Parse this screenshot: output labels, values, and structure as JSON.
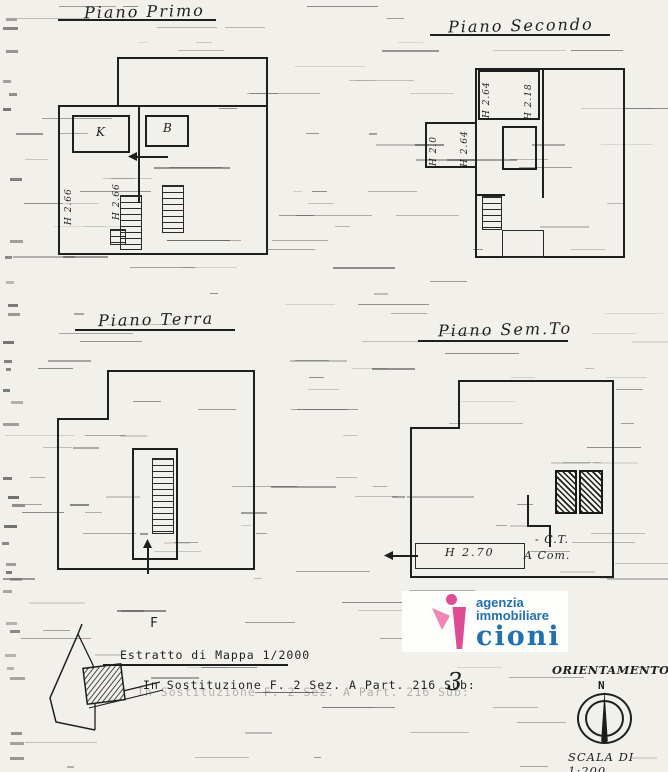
{
  "page": {
    "bg": "#f2f0ea",
    "ink": "#1f1f1f"
  },
  "plans": {
    "primo": {
      "title": "Piano Primo",
      "room_k": "K",
      "room_b": "B",
      "heights": [
        "H 2.66",
        "H 2.66"
      ]
    },
    "secondo": {
      "title": "Piano Secondo",
      "heights": [
        "H 2.64",
        "H 2.18",
        "H 2.0",
        "H 2.64"
      ]
    },
    "terra": {
      "title": "Piano Terra"
    },
    "sem": {
      "title": "Piano Sem.To",
      "height_label": "H 2.70",
      "ct_label": "- C.T.",
      "acom_label": "A Com."
    }
  },
  "footer": {
    "f_label": "F",
    "estratto": "Estratto di Mappa 1/2000",
    "sostituzione": "In Sostituzione  F. 2  Sez. A  Part. 216  Sub:",
    "sub_value": "3"
  },
  "logo": {
    "line1": "agenzia",
    "line2": "immobiliare",
    "line3": "cioni",
    "pink": "#e04b96",
    "pink_light": "#ef86b8",
    "blue": "#2270ae"
  },
  "orientation": {
    "title": "ORIENTAMENTO",
    "north_label": "N",
    "scale_label": "SCALA DI 1:200"
  }
}
